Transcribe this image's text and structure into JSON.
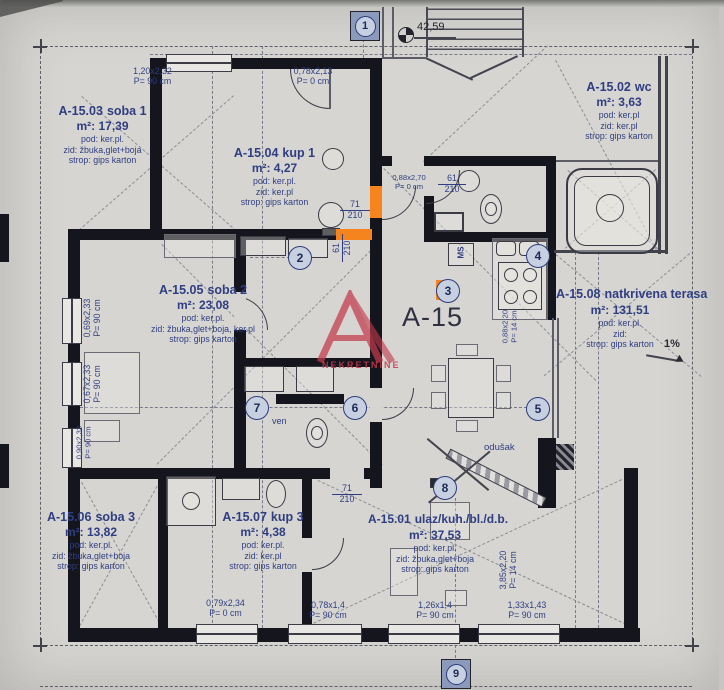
{
  "misc": {
    "plan_code": "A-15",
    "elevation": "42,59",
    "slope": "1%",
    "ms": "MS",
    "ven": "ven",
    "odusak": "odušak",
    "watermark": "NEKRETNINE"
  },
  "markers": [
    "1",
    "2",
    "3",
    "4",
    "5",
    "6",
    "7",
    "8",
    "9"
  ],
  "rooms": [
    {
      "code": "A-15.03",
      "name": "soba 1",
      "area": "m²: 17,39",
      "pod": "pod: ker.pl.",
      "zid": "zid: žbuka,glet+boja",
      "strop": "strop: gips karton"
    },
    {
      "code": "A-15.04",
      "name": "kup 1",
      "area": "m²: 4,27",
      "pod": "pod: ker.pl.",
      "zid": "zid: ker.pl",
      "strop": "strop: gips karton"
    },
    {
      "code": "A-15.02",
      "name": "wc",
      "area": "m²: 3,63",
      "pod": "pod: ker.pl",
      "zid": "zid: ker.pl",
      "strop": "strop: gips karton"
    },
    {
      "code": "A-15.05",
      "name": "soba 2",
      "area": "m²: 23,08",
      "pod": "pod: ker.pl.",
      "zid": "zid: žbuka,glet+boja, ker.pl",
      "strop": "strop: gips karton"
    },
    {
      "code": "A-15.08",
      "name": "natkrivena terasa",
      "area": "m²: 131,51",
      "pod": "pod: ker.pl.",
      "zid": "zid:",
      "strop": "strop: gips karton"
    },
    {
      "code": "A-15.06",
      "name": "soba 3",
      "area": "m²: 13,82",
      "pod": "pod: ker.pl.",
      "zid": "zid: žbuka,glet+boja",
      "strop": "strop: gips karton"
    },
    {
      "code": "A-15.07",
      "name": "kup 3",
      "area": "m²: 4,38",
      "pod": "pod: ker.pl.",
      "zid": "zid: ker.pl",
      "strop": "strop: gips karton"
    },
    {
      "code": "A-15.01",
      "name": "ulaz/kuh./bl./d.b.",
      "area": "m²: 37,53",
      "pod": "pod: ker.pl.",
      "zid": "zid: žbuka,glet+boja",
      "strop": "strop: gips karton"
    }
  ],
  "dims": [
    {
      "a": "1,20x2,32",
      "b": "P= 90 cm"
    },
    {
      "a": "0,78x2,13",
      "b": "P= 0 cm"
    },
    {
      "a": "0,88x2,70",
      "b": "P= 0 cm"
    },
    {
      "a": "0,69x2,33",
      "b": "P= 90 cm"
    },
    {
      "a": "0,67x2,33",
      "b": "P= 90 cm"
    },
    {
      "a": "0,90x2,33",
      "b": "P= 90 cm"
    },
    {
      "a": "0,79x2,34",
      "b": "P= 0 cm"
    },
    {
      "a": "0,78x1,4",
      "b": "P= 90 cm"
    },
    {
      "a": "1,26x1,4",
      "b": "P= 90 cm"
    },
    {
      "a": "1,33x1,43",
      "b": "P= 90 cm"
    },
    {
      "a": "3,85x2,20",
      "b": "P= 14 cm"
    },
    {
      "a": "0,88x2,20",
      "b": "P= 14 cm"
    }
  ],
  "doors": [
    {
      "t": "71",
      "b": "210"
    },
    {
      "t": "61",
      "b": "210"
    },
    {
      "t": "61",
      "b": "210"
    },
    {
      "t": "71",
      "b": "210"
    }
  ]
}
